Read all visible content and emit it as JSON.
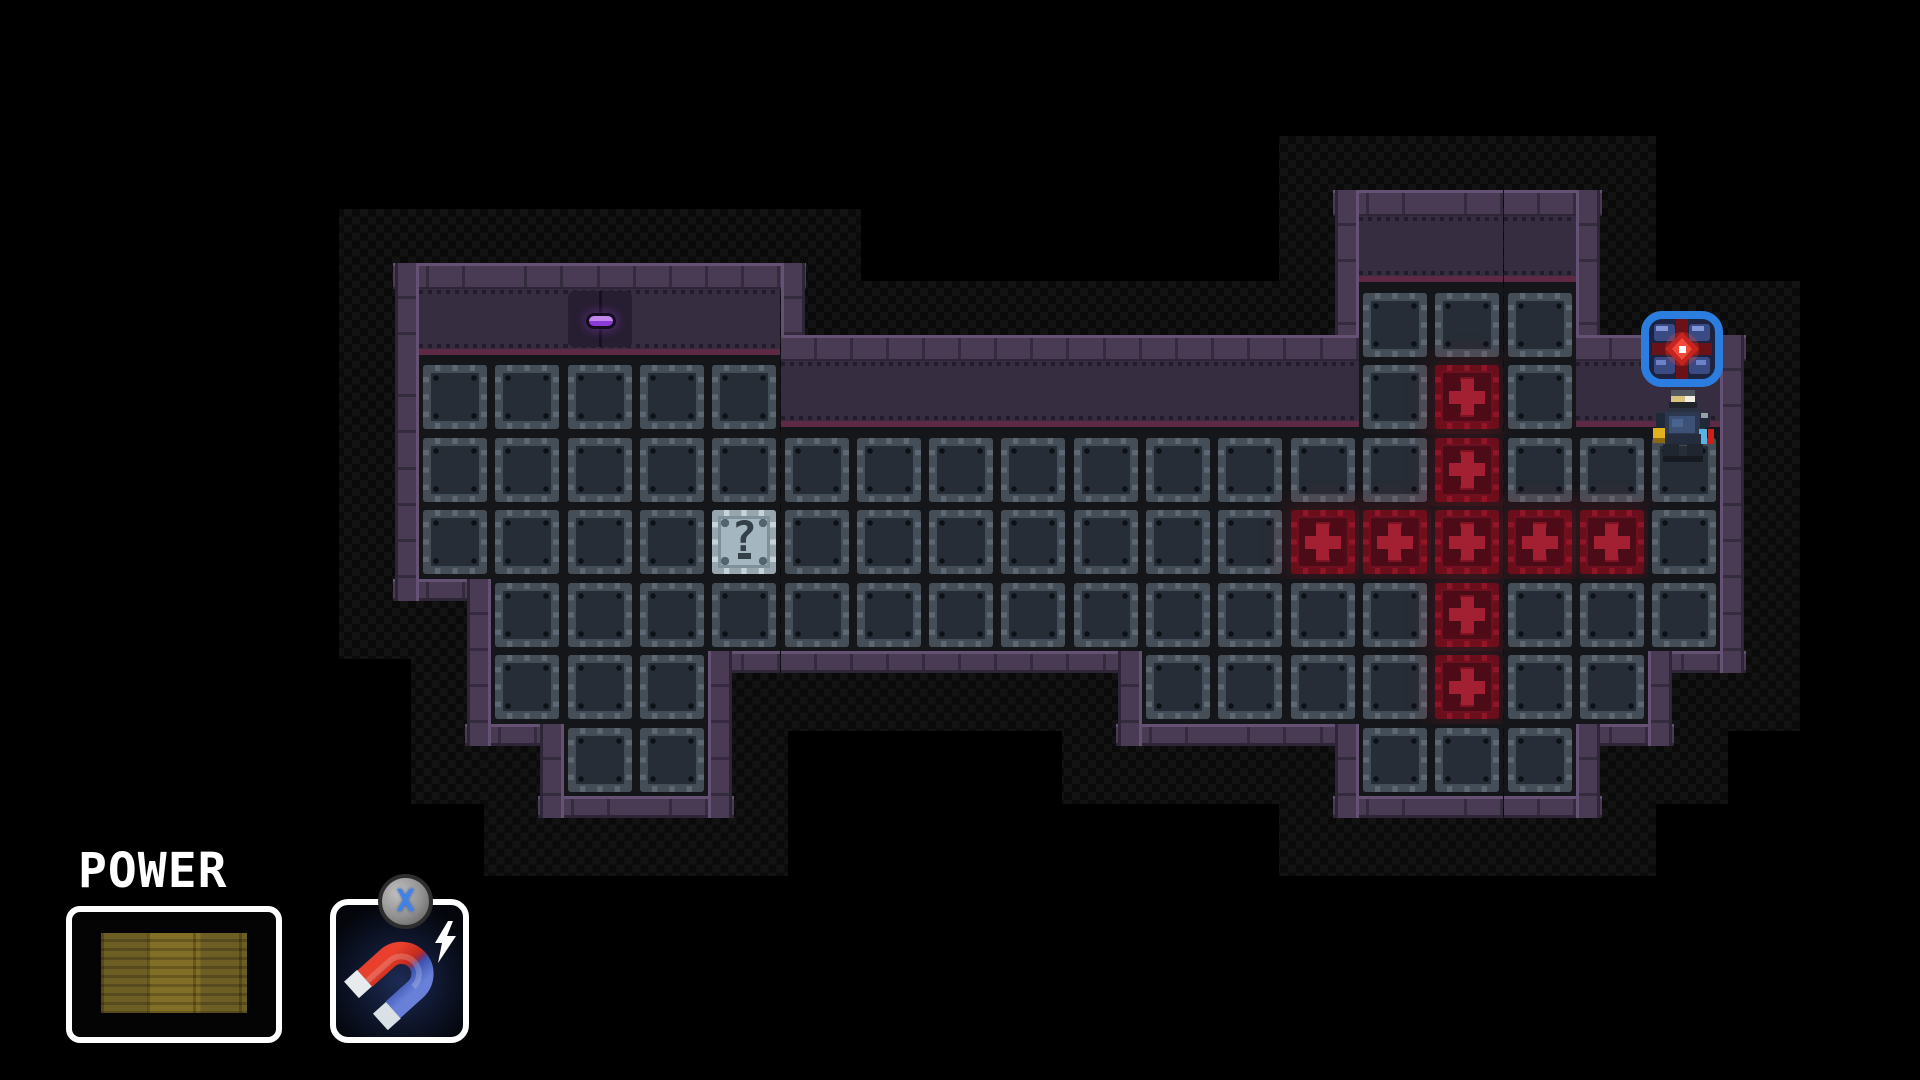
{
  "colors": {
    "shadow_a": "#131313",
    "shadow_b": "#0a0a0a",
    "wall": "#483b53",
    "wall_light": "#645173",
    "wall_dark": "#2e2637",
    "wall_seam": "#342b3e",
    "interior": "#372d41",
    "interior_dot": "#221c2c",
    "magenta": "#5e2944",
    "cell_bg": "#14161a",
    "tile_face": "#262d36",
    "tile_frame": "#5d6872",
    "tile_frame2": "#424d57",
    "rivet": "#0c1116",
    "red_face": "#4c0c17",
    "red_frame": "#8e1627",
    "red_plus": "#a32033",
    "red_core": "#ef6a72",
    "red_glow": "rgba(230,30,50,0.16)",
    "q_bg": "#a4b7c1",
    "q_frame": "#c6d3da",
    "q_inner": "#7e919b",
    "q_glyph": "#333f49",
    "item_outline": "#2b7de0",
    "lever": "#8a3ad6"
  },
  "map": {
    "origin_x": 419,
    "origin_y": 216,
    "cell_w": 72.3,
    "cell_h": 72.5,
    "row_start": -2,
    "cols": 18,
    "legend": {
      ".": "empty",
      "F": "metal-floor-tile",
      "R": "red-hazard-tile",
      "Q": "question-block",
      "I": "floor-with-magnet-core-item",
      "C": "floor-with-player",
      "W": "wall-interior-band",
      "L": "wall-interior-with-lever"
    },
    "tiles": [
      ".............WWW..",
      "WWLWW........FFF..",
      "FFFFFWWWWWWWWFRFWW",
      "FFFFFFFFFFFFFFRFFI",
      "FFFFQFFFFFFFRRRRRC",
      ".FFFFFFFFFFFFFRFFF",
      ".FFF......FFFFRFF.",
      "..FF.........FFF.."
    ]
  },
  "entities": {
    "lever_switch": {
      "col": 2,
      "row": -1
    },
    "question_block": {
      "col": 4,
      "row": 2,
      "glyph": "?"
    },
    "magnet_core_item": {
      "col": 17,
      "row": 1,
      "highlight": "blue-rounded-outline"
    },
    "player": {
      "col": 17,
      "row": 2,
      "facing": "up"
    },
    "hazard_cross_center": {
      "col": 14,
      "row": 2
    }
  },
  "hud": {
    "power": {
      "label": "POWER",
      "fill_percent": 100
    },
    "item_slot": {
      "item": "magnet",
      "hotkey_label": "X",
      "icons": [
        "magnet-icon",
        "lightning-bolt-icon",
        "x-button-badge"
      ]
    }
  }
}
